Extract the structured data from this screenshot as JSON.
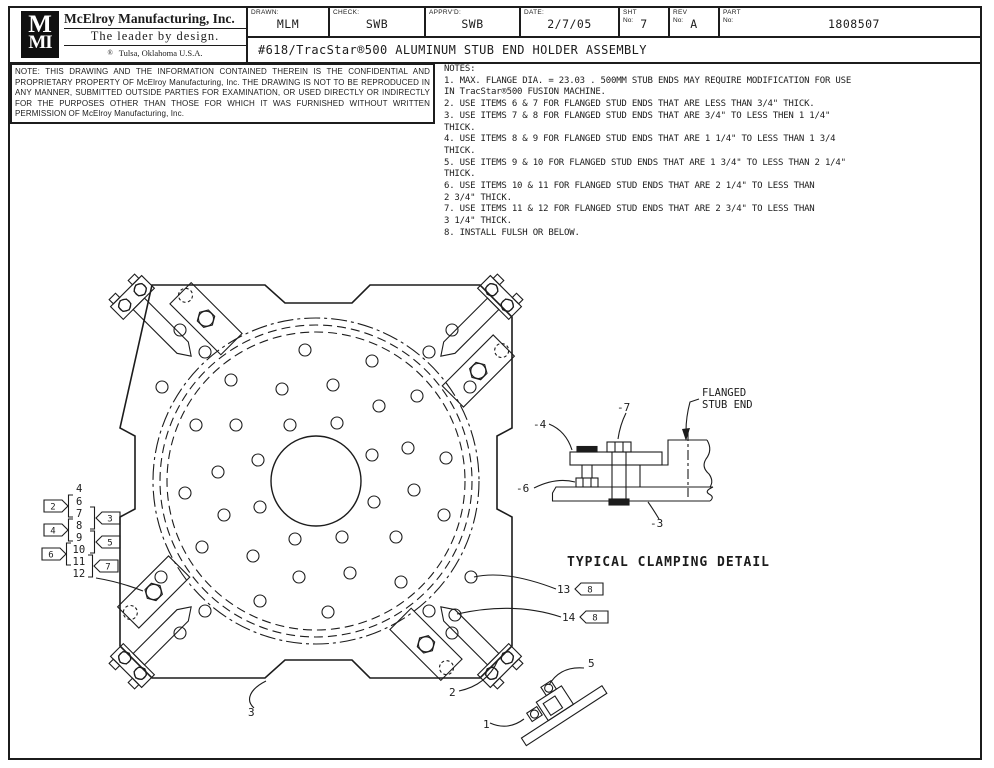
{
  "title_block": {
    "logo_top": "M",
    "logo_bottom": "MI",
    "company": "McElroy Manufacturing, Inc.",
    "tagline": "The leader by design.",
    "reg_mark": "®",
    "location": "Tulsa, Oklahoma U.S.A.",
    "fields": [
      {
        "label": "DRAWN:",
        "value": "MLM"
      },
      {
        "label": "CHECK:",
        "value": "SWB"
      },
      {
        "label": "APPRV'D:",
        "value": "SWB"
      },
      {
        "label": "DATE:",
        "value": "2/7/05"
      },
      {
        "label": "SHT",
        "label2": "No:",
        "value": "7"
      },
      {
        "label": "REV",
        "label2": "No:",
        "value": "A"
      },
      {
        "label": "PART",
        "label2": "No:",
        "value": "1808507"
      }
    ],
    "drawing_title": "#618/TracStar®500 ALUMINUM STUB END HOLDER ASSEMBLY"
  },
  "proprietary_note": "NOTE: THIS DRAWING AND THE INFORMATION CONTAINED THEREIN IS THE CONFIDENTIAL AND PROPRIETARY PROPERTY OF McElroy Manufacturing, Inc. THE DRAWING IS NOT TO BE REPRODUCED IN ANY MANNER, SUBMITTED OUTSIDE PARTIES FOR EXAMINATION, OR USED DIRECTLY OR INDIRECTLY FOR THE PURPOSES OTHER THAN THOSE FOR WHICH IT WAS FURNISHED WITHOUT WRITTEN PERMISSION OF McElroy Manufacturing, Inc.",
  "notes": {
    "heading": "NOTES:",
    "items": [
      "1. MAX. FLANGE DIA. = 23.03 . 500MM STUB ENDS MAY REQUIRE MODIFICATION FOR USE\nIN TracStar®500 FUSION MACHINE.",
      "2. USE ITEMS 6 & 7 FOR FLANGED STUD ENDS THAT ARE LESS THAN 3/4\" THICK.",
      "3. USE ITEMS 7 & 8 FOR FLANGED STUD ENDS THAT ARE 3/4\" TO LESS THEN 1 1/4\"\nTHICK.",
      "4. USE ITEMS 8 & 9 FOR FLANGED STUD ENDS THAT ARE 1 1/4\" TO LESS THAN 1 3/4\nTHICK.",
      "5. USE ITEMS 9 & 10 FOR FLANGED STUD ENDS THAT ARE 1 3/4\" TO LESS THAN 2 1/4\"\nTHICK.",
      "6. USE ITEMS 10 & 11 FOR FLANGED STUD ENDS THAT ARE 2 1/4\" TO LESS THAN\n2 3/4\" THICK.",
      "7. USE ITEMS 11 & 12  FOR FLANGED STUD ENDS THAT ARE 2 3/4\" TO LESS THAN\n3 1/4\" THICK.",
      "8. INSTALL FULSH OR BELOW."
    ]
  },
  "drawing": {
    "detail_title": "TYPICAL CLAMPING DETAIL",
    "flanged_label_line1": "FLANGED",
    "flanged_label_line2": "STUB END",
    "detail_refs": {
      "clamp": "-4",
      "bolt": "-7",
      "jack_bolt": "-6",
      "base": "-3"
    },
    "item_refs": {
      "bracket": "1",
      "corner_clamp": "2",
      "plate": "3",
      "bracket_screws": "5",
      "screw_13": "13",
      "screw_14": "14"
    },
    "note_flags": {
      "flag_13": "8",
      "flag_14": "8"
    },
    "item_stack": {
      "top": "4",
      "items": [
        "6",
        "7",
        "8",
        "9",
        "10",
        "11",
        "12"
      ],
      "left_flags": [
        "2",
        "4",
        "6"
      ],
      "right_flags": [
        "3",
        "5",
        "7"
      ]
    }
  }
}
